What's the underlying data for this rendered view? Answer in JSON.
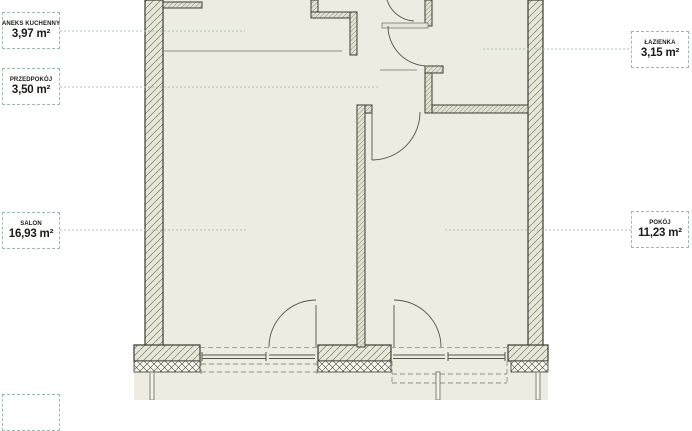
{
  "plan": {
    "type": "apartment-floor-plan",
    "units": "m²",
    "rooms": [
      {
        "name": "ANEKS KUCHENNY",
        "area": "3,97 m²"
      },
      {
        "name": "PRZEDPOKÓJ",
        "area": "3,50 m²"
      },
      {
        "name": "SALON",
        "area": "16,93 m²"
      },
      {
        "name": "ŁAZIENKA",
        "area": "3,15 m²"
      },
      {
        "name": "POKÓJ",
        "area": "11,23 m²"
      }
    ],
    "colors": {
      "background": "#ffffff",
      "room_fill": "#ecece0",
      "wall_line": "#3b3b33",
      "label_border": "#9cbcab",
      "leader_line": "#a9c3b3"
    }
  }
}
